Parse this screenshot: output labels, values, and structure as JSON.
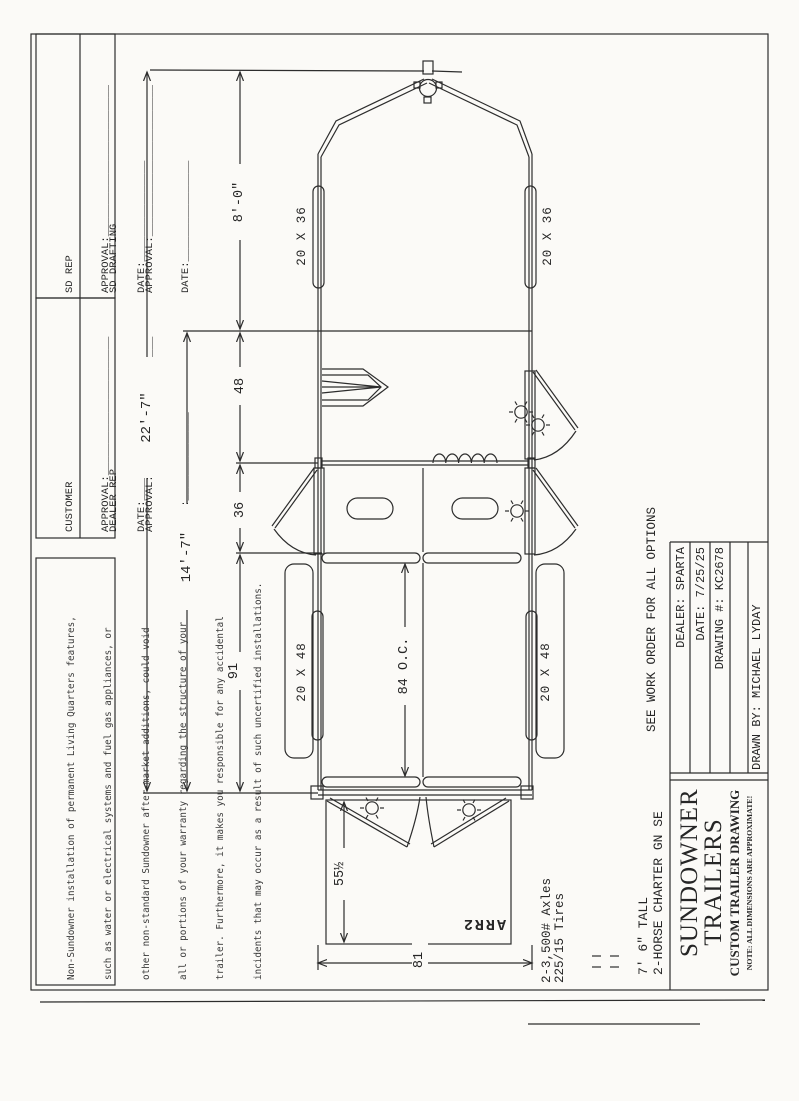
{
  "sheet": {
    "paper": "#fbfaf7",
    "ink": "#2d2d2d"
  },
  "approvals": {
    "cells": [
      {
        "title": "SD REP",
        "approval_line": "APPROVAL:________________________",
        "date_line": "DATE:________________"
      },
      {
        "title": "SD DRAFTING",
        "approval_line": "APPROVAL:________________________",
        "date_line": "DATE:________________"
      },
      {
        "title": "CUSTOMER",
        "approval_line": "APPROVAL:______________________",
        "date_line": "DATE:______________"
      },
      {
        "title": "DEALER REP",
        "approval_line": "APPROVAL:______________________",
        "date_line": "DATE:______________"
      }
    ]
  },
  "disclaimer": {
    "lines": [
      "Non-Sundowner installation of permanent Living Quarters features,",
      "such as water or electrical systems and fuel gas appliances, or",
      "other non-standard Sundowner after-market additions, could void",
      "all or portions of your warranty regarding the structure of your",
      "trailer. Furthermore, it makes you responsible for any accidental",
      "incidents that may occur as a result of such uncertified installations."
    ]
  },
  "dimensions": {
    "overall": "22'-7\"",
    "gooseneck": "8'-0\"",
    "main_floor": "14'-7\"",
    "dress_area": "48",
    "mid_tack": "36",
    "stall_area": "91",
    "stall_centers": "84 O.C.",
    "door_swing": "55½",
    "rear_width": "81"
  },
  "windows": {
    "gooseneck_left": "20 X 36",
    "gooseneck_right": "20 X 36",
    "stall_left": "20 X 48",
    "stall_right": "20 X 48"
  },
  "title_block": {
    "see_work_order": "SEE WORK ORDER FOR ALL OPTIONS",
    "dealer": "DEALER: SPARTA",
    "date": "DATE: 7/25/25",
    "drawing": "DRAWING #: KC2678",
    "drawn_by": "DRAWN BY: MICHAEL LYDAY",
    "company1": "SUNDOWNER",
    "company2": "TRAILERS",
    "subtitle": "CUSTOM TRAILER DRAWING",
    "note": "NOTE: ALL DIMENSIONS ARE APPROXIMATE!"
  },
  "specs": {
    "height": "7' 6\" TALL",
    "model": "2-HORSE CHARTER GN SE",
    "axles": "2-3,500# Axles",
    "tires": "225/15 Tires",
    "stamp": "ARR2"
  }
}
